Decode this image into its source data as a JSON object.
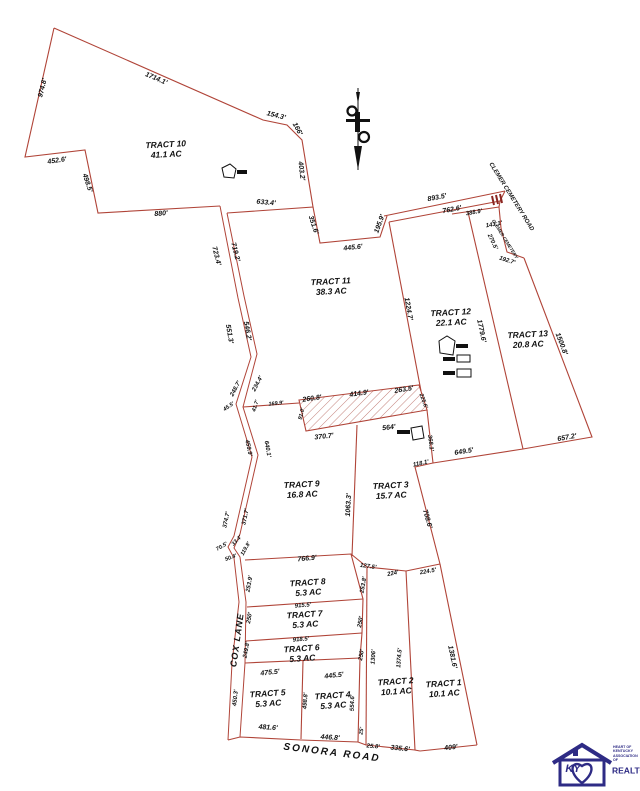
{
  "map": {
    "type": "subdivision plat",
    "line_color": "#b04438",
    "hatch_color": "#c4837c",
    "text_color": "#111111",
    "logo_color": "#2e2b85"
  },
  "tracts": [
    {
      "name": "TRACT 10",
      "acres": "41.1 AC",
      "x": 166,
      "y": 150,
      "r": -3
    },
    {
      "name": "TRACT 11",
      "acres": "38.3 AC",
      "x": 331,
      "y": 287,
      "r": -3
    },
    {
      "name": "TRACT 12",
      "acres": "22.1 AC",
      "x": 451,
      "y": 318,
      "r": -3
    },
    {
      "name": "TRACT 13",
      "acres": "20.8 AC",
      "x": 528,
      "y": 340,
      "r": -3
    },
    {
      "name": "TRACT 9",
      "acres": "16.8 AC",
      "x": 302,
      "y": 490,
      "r": -3
    },
    {
      "name": "TRACT 3",
      "acres": "15.7 AC",
      "x": 391,
      "y": 491,
      "r": -3
    },
    {
      "name": "TRACT 8",
      "acres": "5.3 AC",
      "x": 308,
      "y": 588,
      "r": -4
    },
    {
      "name": "TRACT 7",
      "acres": "5.3 AC",
      "x": 305,
      "y": 620,
      "r": -4
    },
    {
      "name": "TRACT 6",
      "acres": "5.3 AC",
      "x": 302,
      "y": 654,
      "r": -4
    },
    {
      "name": "TRACT 5",
      "acres": "5.3 AC",
      "x": 268,
      "y": 699,
      "r": -4
    },
    {
      "name": "TRACT 4",
      "acres": "5.3 AC",
      "x": 333,
      "y": 701,
      "r": -4
    },
    {
      "name": "TRACT 2",
      "acres": "10.1 AC",
      "x": 396,
      "y": 687,
      "r": -4
    },
    {
      "name": "TRACT 1",
      "acres": "10.1 AC",
      "x": 444,
      "y": 689,
      "r": -4
    }
  ],
  "dimensions": [
    {
      "t": "974.8'",
      "x": 43,
      "y": 88,
      "r": -76
    },
    {
      "t": "1714.1'",
      "x": 156,
      "y": 79,
      "r": 23
    },
    {
      "t": "154.3'",
      "x": 276,
      "y": 116,
      "r": 14
    },
    {
      "t": "166'",
      "x": 297,
      "y": 129,
      "r": 62
    },
    {
      "t": "452.6'",
      "x": 57,
      "y": 161,
      "r": -8
    },
    {
      "t": "498.5'",
      "x": 87,
      "y": 183,
      "r": 72
    },
    {
      "t": "880'",
      "x": 161,
      "y": 214,
      "r": -4
    },
    {
      "t": "403.2'",
      "x": 301,
      "y": 171,
      "r": 83
    },
    {
      "t": "633.4'",
      "x": 266,
      "y": 203,
      "r": 5
    },
    {
      "t": "351.6'",
      "x": 313,
      "y": 225,
      "r": 72
    },
    {
      "t": "445.6'",
      "x": 353,
      "y": 248,
      "r": -6
    },
    {
      "t": "195.9'",
      "x": 380,
      "y": 224,
      "r": -70
    },
    {
      "t": "893.5'",
      "x": 437,
      "y": 198,
      "r": -11
    },
    {
      "t": "762.6'",
      "x": 452,
      "y": 210,
      "r": -11
    },
    {
      "t": "388.9'",
      "x": 474,
      "y": 213,
      "r": -10,
      "s": 6
    },
    {
      "t": "143.1'",
      "x": 494,
      "y": 225,
      "r": -10,
      "s": 6
    },
    {
      "t": "270.5'",
      "x": 492,
      "y": 242,
      "r": 65,
      "s": 6
    },
    {
      "t": "192.7'",
      "x": 507,
      "y": 261,
      "r": 18,
      "s": 6
    },
    {
      "t": "1224.7'",
      "x": 408,
      "y": 309,
      "r": 80
    },
    {
      "t": "1779.6'",
      "x": 481,
      "y": 331,
      "r": 78
    },
    {
      "t": "1500.8'",
      "x": 561,
      "y": 344,
      "r": 69
    },
    {
      "t": "657.2'",
      "x": 567,
      "y": 438,
      "r": -10
    },
    {
      "t": "649.5'",
      "x": 464,
      "y": 452,
      "r": -9
    },
    {
      "t": "368.1'",
      "x": 430,
      "y": 443,
      "r": 83,
      "s": 6
    },
    {
      "t": "118.1'",
      "x": 421,
      "y": 464,
      "r": -12,
      "s": 6
    },
    {
      "t": "708.6'",
      "x": 427,
      "y": 519,
      "r": 74
    },
    {
      "t": "723.4'",
      "x": 216,
      "y": 256,
      "r": 76
    },
    {
      "t": "719.2'",
      "x": 235,
      "y": 252,
      "r": 76
    },
    {
      "t": "551.3'",
      "x": 229,
      "y": 334,
      "r": 80
    },
    {
      "t": "546.2'",
      "x": 247,
      "y": 331,
      "r": 80
    },
    {
      "t": "248.7'",
      "x": 236,
      "y": 389,
      "r": -62,
      "s": 6
    },
    {
      "t": "234.4'",
      "x": 258,
      "y": 384,
      "r": -62,
      "s": 6
    },
    {
      "t": "45.5'",
      "x": 229,
      "y": 407,
      "r": -35,
      "s": 5.5
    },
    {
      "t": "41.7'",
      "x": 256,
      "y": 406,
      "r": -72,
      "s": 5.5
    },
    {
      "t": "169.9'",
      "x": 276,
      "y": 404,
      "r": -6,
      "s": 5.5
    },
    {
      "t": "91.0'",
      "x": 302,
      "y": 414,
      "r": -75,
      "s": 5.5
    },
    {
      "t": "260.8'",
      "x": 312,
      "y": 399,
      "r": -8
    },
    {
      "t": "414.9'",
      "x": 359,
      "y": 394,
      "r": -8
    },
    {
      "t": "263.5'",
      "x": 404,
      "y": 390,
      "r": -9
    },
    {
      "t": "225.6'",
      "x": 423,
      "y": 401,
      "r": 70,
      "s": 5.5
    },
    {
      "t": "370.7'",
      "x": 324,
      "y": 437,
      "r": -6
    },
    {
      "t": "564'",
      "x": 389,
      "y": 428,
      "r": -7
    },
    {
      "t": "459.9'",
      "x": 248,
      "y": 448,
      "r": 78,
      "s": 6
    },
    {
      "t": "640.1'",
      "x": 267,
      "y": 449,
      "r": 80,
      "s": 6
    },
    {
      "t": "374.7'",
      "x": 227,
      "y": 520,
      "r": -78,
      "s": 6
    },
    {
      "t": "371.7'",
      "x": 246,
      "y": 517,
      "r": -78,
      "s": 6
    },
    {
      "t": "70.5'",
      "x": 222,
      "y": 547,
      "r": -30,
      "s": 5.5
    },
    {
      "t": "33.4'",
      "x": 237,
      "y": 541,
      "r": -45,
      "s": 5.5
    },
    {
      "t": "119.8'",
      "x": 246,
      "y": 549,
      "r": -60,
      "s": 5.5
    },
    {
      "t": "50.4'",
      "x": 231,
      "y": 558,
      "r": -20,
      "s": 5.5
    },
    {
      "t": "1063.3'",
      "x": 349,
      "y": 505,
      "r": -87
    },
    {
      "t": "766.9'",
      "x": 307,
      "y": 559,
      "r": -5
    },
    {
      "t": "127.5'",
      "x": 368,
      "y": 567,
      "r": 8,
      "s": 6
    },
    {
      "t": "253.9'",
      "x": 250,
      "y": 584,
      "r": -80,
      "s": 6
    },
    {
      "t": "253.8'",
      "x": 364,
      "y": 585,
      "r": -80,
      "s": 6
    },
    {
      "t": "915.5'",
      "x": 303,
      "y": 606,
      "r": -5,
      "s": 6
    },
    {
      "t": "250'",
      "x": 250,
      "y": 618,
      "r": -80,
      "s": 6
    },
    {
      "t": "250'",
      "x": 361,
      "y": 622,
      "r": -80,
      "s": 6
    },
    {
      "t": "918.5'",
      "x": 301,
      "y": 640,
      "r": -5,
      "s": 6
    },
    {
      "t": "249.8'",
      "x": 247,
      "y": 650,
      "r": -80,
      "s": 6
    },
    {
      "t": "250'",
      "x": 362,
      "y": 655,
      "r": -80,
      "s": 6
    },
    {
      "t": "475.5'",
      "x": 270,
      "y": 673,
      "r": -6
    },
    {
      "t": "445.5'",
      "x": 334,
      "y": 676,
      "r": -6
    },
    {
      "t": "224'",
      "x": 393,
      "y": 574,
      "r": -12,
      "s": 6
    },
    {
      "t": "224.5'",
      "x": 428,
      "y": 572,
      "r": -10,
      "s": 6
    },
    {
      "t": "1306'",
      "x": 374,
      "y": 657,
      "r": -86,
      "s": 6
    },
    {
      "t": "1374.5'",
      "x": 400,
      "y": 658,
      "r": -86,
      "s": 6
    },
    {
      "t": "1381.6'",
      "x": 452,
      "y": 657,
      "r": 78
    },
    {
      "t": "450.3'",
      "x": 236,
      "y": 698,
      "r": -84,
      "s": 6
    },
    {
      "t": "498.8'",
      "x": 306,
      "y": 701,
      "r": -86,
      "s": 6
    },
    {
      "t": "554.6'",
      "x": 353,
      "y": 703,
      "r": -88,
      "s": 6
    },
    {
      "t": "481.6'",
      "x": 268,
      "y": 728,
      "r": 4
    },
    {
      "t": "446.8'",
      "x": 330,
      "y": 738,
      "r": 4
    },
    {
      "t": "25'",
      "x": 362,
      "y": 731,
      "r": -80,
      "s": 5.5
    },
    {
      "t": "25.8'",
      "x": 373,
      "y": 747,
      "r": 5,
      "s": 6
    },
    {
      "t": "335.6'",
      "x": 400,
      "y": 749,
      "r": 6
    },
    {
      "t": "409'",
      "x": 451,
      "y": 748,
      "r": -7
    }
  ],
  "roads": [
    {
      "t": "COX LANE",
      "x": 237,
      "y": 640,
      "r": -82,
      "s": 9,
      "ls": 1
    },
    {
      "t": "SONORA ROAD",
      "x": 332,
      "y": 753,
      "r": 7,
      "s": 10,
      "ls": 2
    },
    {
      "t": "CLEMER CEMETERY ROAD",
      "x": 511,
      "y": 197,
      "r": 58,
      "s": 6,
      "ls": 0
    },
    {
      "t": "CLEMER CEMETERY",
      "x": 505,
      "y": 239,
      "r": 58,
      "s": 4.5,
      "ls": 0
    }
  ],
  "logo": {
    "ky": "KY",
    "line1": "HEART OF KENTUCKY",
    "line2": "ASSOCIATION OF",
    "line3": "REALTORS®"
  }
}
